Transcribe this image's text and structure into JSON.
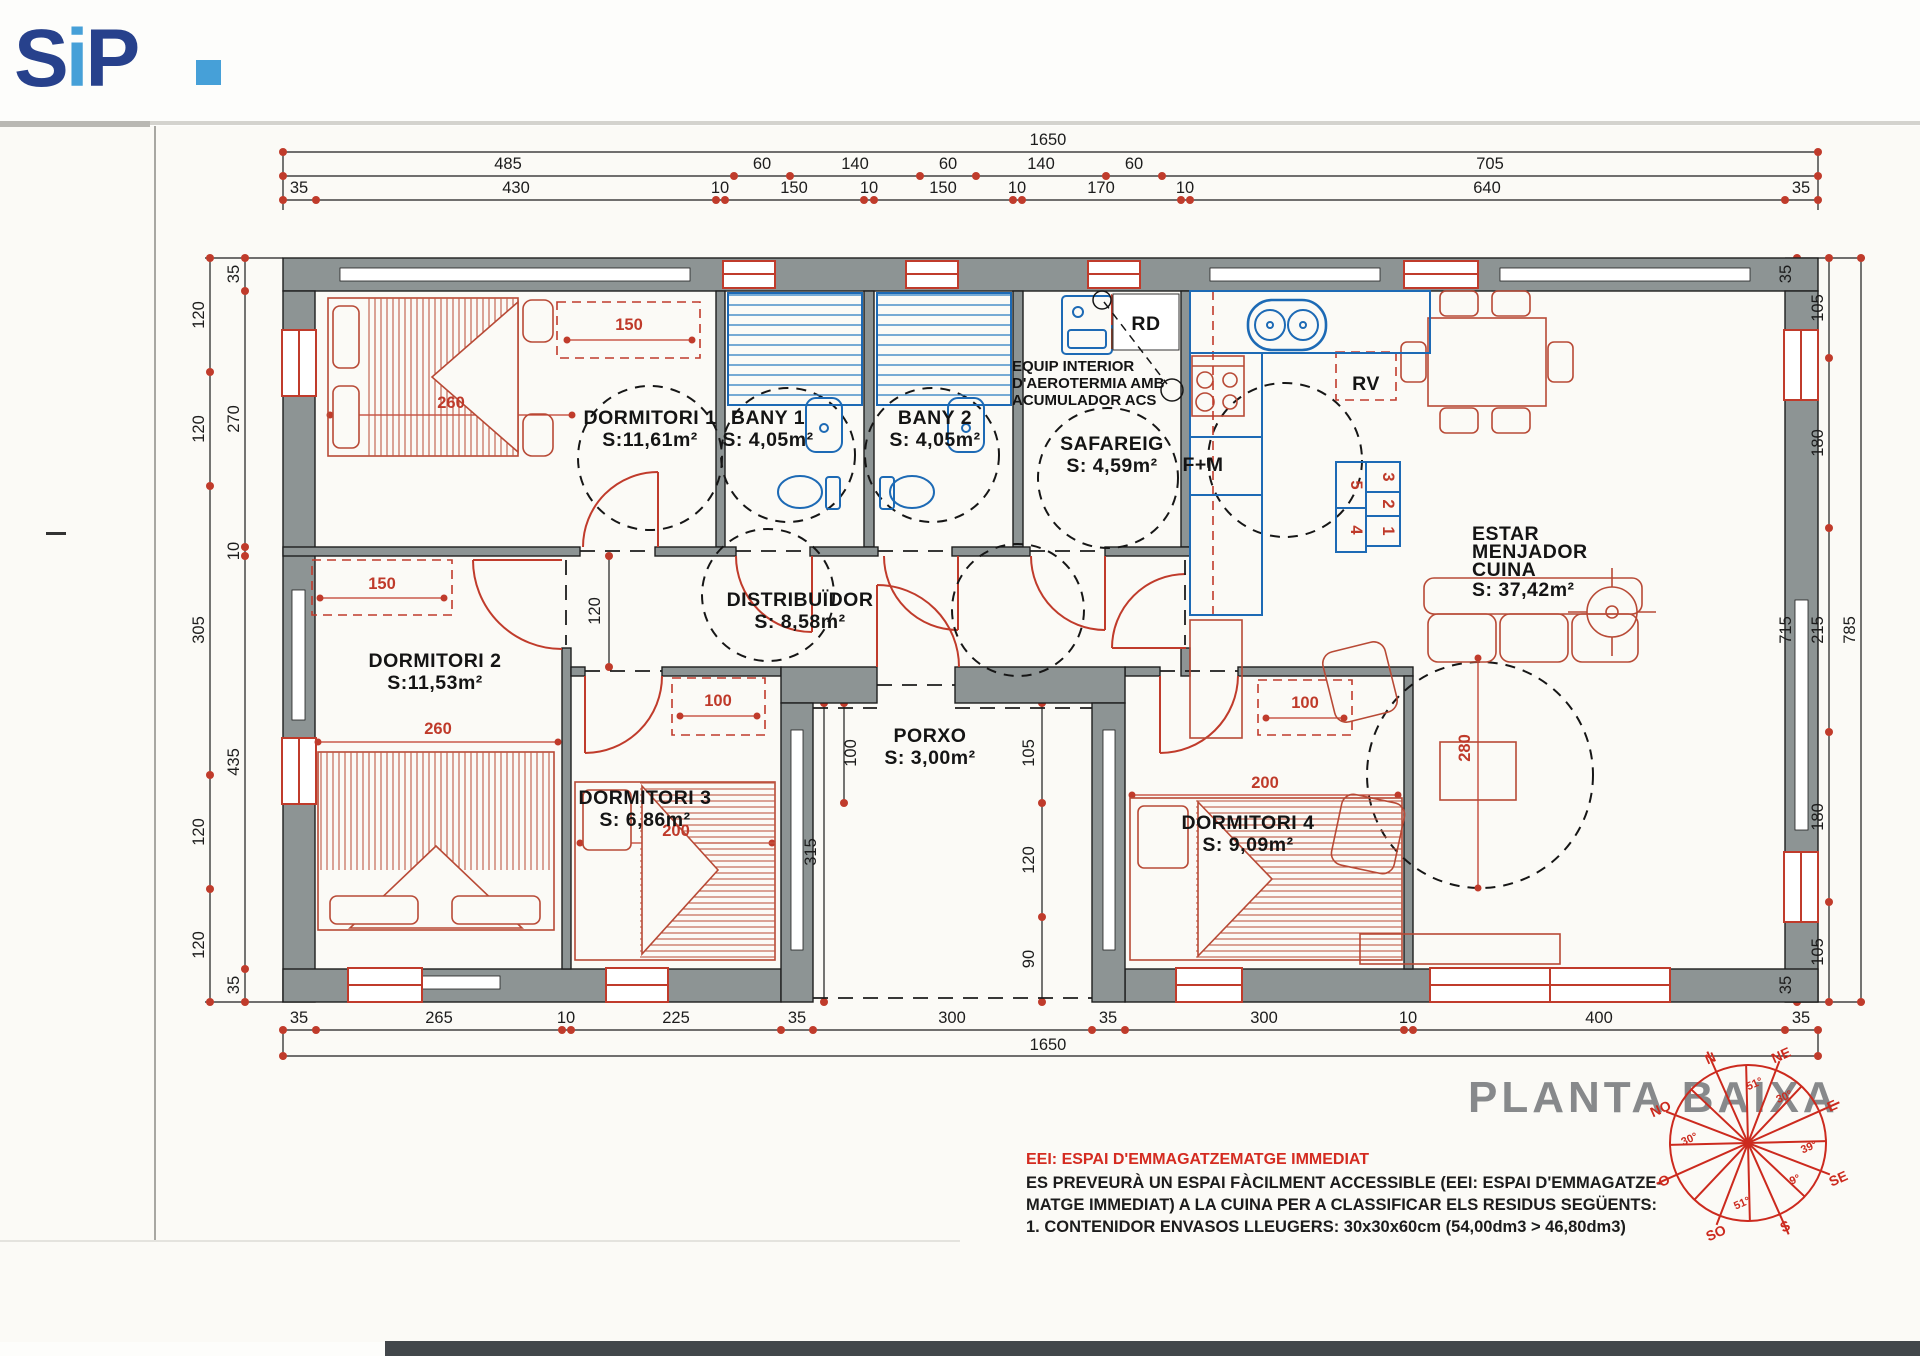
{
  "logo": {
    "s": "S",
    "i": "i",
    "p": "P",
    "color_dark": "#27418c",
    "color_light": "#46a0d8"
  },
  "plan_title": "PLANTA BAIXA",
  "rooms": {
    "dormitori1": {
      "name": "DORMITORI 1",
      "area": "S:11,61m²"
    },
    "bany1": {
      "name": "BANY 1",
      "area": "S: 4,05m²"
    },
    "bany2": {
      "name": "BANY 2",
      "area": "S: 4,05m²"
    },
    "safareig": {
      "name": "SAFAREIG",
      "area": "S: 4,59m²"
    },
    "dormitori2": {
      "name": "DORMITORI 2",
      "area": "S:11,53m²"
    },
    "distribuidor": {
      "name": "DISTRIBUÏDOR",
      "area": "S: 8,58m²"
    },
    "porxo": {
      "name": "PORXO",
      "area": "S: 3,00m²"
    },
    "dormitori3": {
      "name": "DORMITORI 3",
      "area": "S: 6,86m²"
    },
    "dormitori4": {
      "name": "DORMITORI 4",
      "area": "S: 9,09m²"
    },
    "estar": {
      "l1": "ESTAR",
      "l2": "MENJADOR",
      "l3": "CUINA",
      "area": "S: 37,42m²"
    }
  },
  "labels": {
    "rd": "RD",
    "rv": "RV",
    "fm": "F+M",
    "equip1": "EQUIP INTERIOR",
    "equip2": "D'AEROTERMIA AMB",
    "equip3": "ACUMULADOR ACS"
  },
  "containers": [
    "5",
    "3",
    "2",
    "4",
    "1"
  ],
  "dims": {
    "top1": [
      "1650"
    ],
    "top2": [
      "485",
      "60",
      "140",
      "60",
      "140",
      "60",
      "705"
    ],
    "top3": [
      "35",
      "430",
      "10",
      "150",
      "10",
      "150",
      "10",
      "170",
      "10",
      "640",
      "35"
    ],
    "bottom1": [
      "35",
      "265",
      "10",
      "225",
      "35",
      "300",
      "35",
      "300",
      "10",
      "400",
      "35"
    ],
    "bottom2": [
      "1650"
    ],
    "left_outer": [
      "120",
      "120",
      "305",
      "120",
      "120"
    ],
    "left_inner": [
      "35",
      "270",
      "10",
      "435",
      "35"
    ],
    "right_inner": [
      "35",
      "715",
      "35"
    ],
    "right_mid": [
      "105",
      "180",
      "215",
      "180",
      "105"
    ],
    "right_outer": [
      "785"
    ],
    "interior": [
      "120",
      "100",
      "315",
      "105",
      "120",
      "90"
    ],
    "red": [
      "150",
      "260",
      "150",
      "260",
      "100",
      "200",
      "100",
      "200",
      "280"
    ]
  },
  "notes": {
    "title": "EEI: ESPAI D'EMMAGATZEMATGE IMMEDIAT",
    "line1": "ES PREVEURÀ UN ESPAI FÀCILMENT ACCESSIBLE (EEI: ESPAI D'EMMAGATZE-",
    "line2": "MATGE IMMEDIAT) A LA CUINA PER A CLASSIFICAR ELS RESIDUS SEGÜENTS:",
    "line3": "1. CONTENIDOR ENVASOS LLEUGERS:  30x30x60cm (54,00dm3 > 46,80dm3)"
  },
  "compass": {
    "points": [
      "N",
      "NE",
      "E",
      "SE",
      "S",
      "SO",
      "O",
      "NO"
    ],
    "degrees": [
      "51°",
      "30°",
      "39°",
      "9°",
      "51°",
      "30°"
    ]
  }
}
